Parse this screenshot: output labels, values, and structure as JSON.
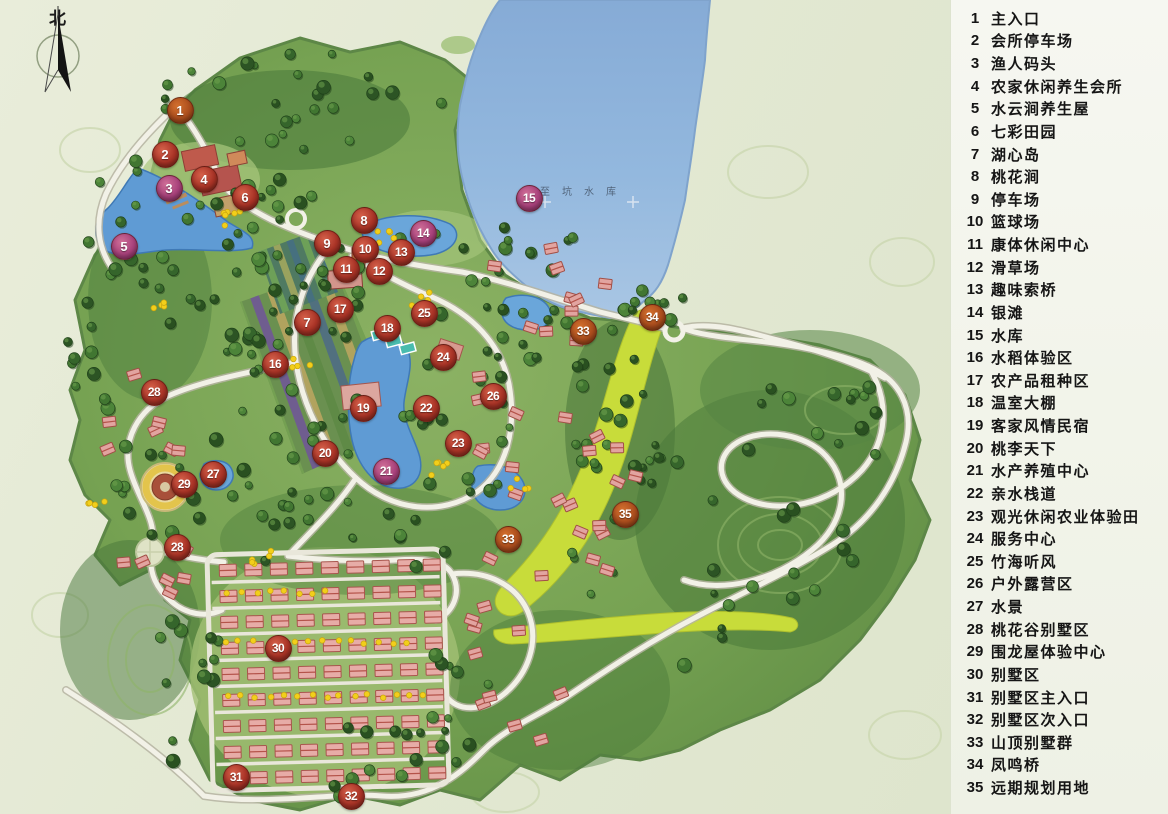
{
  "compass": {
    "north_label": "北"
  },
  "map": {
    "reservoir_label": "至坑水库",
    "markers": [
      {
        "num": "1",
        "x": 180,
        "y": 110,
        "variant": "rust",
        "label": "主入口"
      },
      {
        "num": "2",
        "x": 165,
        "y": 154,
        "variant": "red",
        "label": "会所停车场"
      },
      {
        "num": "3",
        "x": 169,
        "y": 188,
        "variant": "magenta",
        "label": "渔人码头"
      },
      {
        "num": "4",
        "x": 204,
        "y": 179,
        "variant": "red",
        "label": "农家休闲养生会所"
      },
      {
        "num": "5",
        "x": 124,
        "y": 246,
        "variant": "magenta",
        "label": "水云涧养生屋"
      },
      {
        "num": "6",
        "x": 245,
        "y": 197,
        "variant": "red",
        "label": "七彩田园"
      },
      {
        "num": "7",
        "x": 307,
        "y": 322,
        "variant": "red",
        "label": "湖心岛"
      },
      {
        "num": "8",
        "x": 364,
        "y": 220,
        "variant": "red",
        "label": "桃花涧"
      },
      {
        "num": "9",
        "x": 327,
        "y": 243,
        "variant": "red",
        "label": "停车场"
      },
      {
        "num": "10",
        "x": 365,
        "y": 249,
        "variant": "red",
        "label": "篮球场"
      },
      {
        "num": "11",
        "x": 346,
        "y": 269,
        "variant": "red",
        "label": "康体休闲中心"
      },
      {
        "num": "12",
        "x": 379,
        "y": 271,
        "variant": "red",
        "label": "滑草场"
      },
      {
        "num": "13",
        "x": 401,
        "y": 252,
        "variant": "red",
        "label": "趣味索桥"
      },
      {
        "num": "14",
        "x": 423,
        "y": 233,
        "variant": "magenta",
        "label": "银滩"
      },
      {
        "num": "15",
        "x": 529,
        "y": 198,
        "variant": "magenta",
        "label": "水库"
      },
      {
        "num": "16",
        "x": 275,
        "y": 364,
        "variant": "red",
        "label": "水稻体验区"
      },
      {
        "num": "17",
        "x": 340,
        "y": 309,
        "variant": "red",
        "label": "农产品租种区"
      },
      {
        "num": "18",
        "x": 387,
        "y": 328,
        "variant": "red",
        "label": "温室大棚"
      },
      {
        "num": "19",
        "x": 363,
        "y": 408,
        "variant": "red",
        "label": "客家风情民宿"
      },
      {
        "num": "20",
        "x": 325,
        "y": 453,
        "variant": "red",
        "label": "桃李天下"
      },
      {
        "num": "21",
        "x": 386,
        "y": 471,
        "variant": "magenta",
        "label": "水产养殖中心"
      },
      {
        "num": "22",
        "x": 426,
        "y": 408,
        "variant": "red",
        "label": "亲水栈道"
      },
      {
        "num": "23",
        "x": 458,
        "y": 443,
        "variant": "red",
        "label": "观光休闲农业体验田"
      },
      {
        "num": "24",
        "x": 443,
        "y": 357,
        "variant": "red",
        "label": "服务中心"
      },
      {
        "num": "25",
        "x": 424,
        "y": 313,
        "variant": "red",
        "label": "竹海听风"
      },
      {
        "num": "26",
        "x": 493,
        "y": 396,
        "variant": "red",
        "label": "户外露营区"
      },
      {
        "num": "27",
        "x": 213,
        "y": 474,
        "variant": "red",
        "label": "水景"
      },
      {
        "num": "28",
        "x": 154,
        "y": 392,
        "variant": "red",
        "label": "桃花谷别墅区"
      },
      {
        "num": "28",
        "x": 177,
        "y": 547,
        "variant": "red",
        "label": "桃花谷别墅区"
      },
      {
        "num": "29",
        "x": 184,
        "y": 484,
        "variant": "red",
        "label": "围龙屋体验中心"
      },
      {
        "num": "30",
        "x": 278,
        "y": 648,
        "variant": "red",
        "label": "别墅区"
      },
      {
        "num": "31",
        "x": 236,
        "y": 777,
        "variant": "red",
        "label": "别墅区主入口"
      },
      {
        "num": "32",
        "x": 351,
        "y": 796,
        "variant": "red",
        "label": "别墅区次入口"
      },
      {
        "num": "33",
        "x": 583,
        "y": 331,
        "variant": "rust",
        "label": "山顶别墅群"
      },
      {
        "num": "33",
        "x": 508,
        "y": 539,
        "variant": "rust",
        "label": "山顶别墅群"
      },
      {
        "num": "34",
        "x": 652,
        "y": 317,
        "variant": "rust",
        "label": "凤鸣桥"
      },
      {
        "num": "35",
        "x": 625,
        "y": 514,
        "variant": "rust",
        "label": "远期规划用地"
      }
    ]
  },
  "legend": {
    "items": [
      {
        "num": "1",
        "label": "主入口"
      },
      {
        "num": "2",
        "label": "会所停车场"
      },
      {
        "num": "3",
        "label": "渔人码头"
      },
      {
        "num": "4",
        "label": "农家休闲养生会所"
      },
      {
        "num": "5",
        "label": "水云涧养生屋"
      },
      {
        "num": "6",
        "label": "七彩田园"
      },
      {
        "num": "7",
        "label": "湖心岛"
      },
      {
        "num": "8",
        "label": "桃花涧"
      },
      {
        "num": "9",
        "label": "停车场"
      },
      {
        "num": "10",
        "label": "篮球场"
      },
      {
        "num": "11",
        "label": "康体休闲中心"
      },
      {
        "num": "12",
        "label": "滑草场"
      },
      {
        "num": "13",
        "label": "趣味索桥"
      },
      {
        "num": "14",
        "label": "银滩"
      },
      {
        "num": "15",
        "label": "水库"
      },
      {
        "num": "16",
        "label": "水稻体验区"
      },
      {
        "num": "17",
        "label": "农产品租种区"
      },
      {
        "num": "18",
        "label": "温室大棚"
      },
      {
        "num": "19",
        "label": "客家风情民宿"
      },
      {
        "num": "20",
        "label": "桃李天下"
      },
      {
        "num": "21",
        "label": "水产养殖中心"
      },
      {
        "num": "22",
        "label": "亲水栈道"
      },
      {
        "num": "23",
        "label": "观光休闲农业体验田"
      },
      {
        "num": "24",
        "label": "服务中心"
      },
      {
        "num": "25",
        "label": "竹海听风"
      },
      {
        "num": "26",
        "label": "户外露营区"
      },
      {
        "num": "27",
        "label": "水景"
      },
      {
        "num": "28",
        "label": "桃花谷别墅区"
      },
      {
        "num": "29",
        "label": "围龙屋体验中心"
      },
      {
        "num": "30",
        "label": "别墅区"
      },
      {
        "num": "31",
        "label": "别墅区主入口"
      },
      {
        "num": "32",
        "label": "别墅区次入口"
      },
      {
        "num": "33",
        "label": "山顶别墅群"
      },
      {
        "num": "34",
        "label": "凤鸣桥"
      },
      {
        "num": "35",
        "label": "远期规划用地"
      }
    ]
  },
  "colors": {
    "marker_variants": {
      "red": {
        "light": "#d4604a",
        "base": "#a93326",
        "dark": "#76241a"
      },
      "magenta": {
        "light": "#cf6e97",
        "base": "#a8417b",
        "dark": "#772c56"
      },
      "rust": {
        "light": "#d3702e",
        "base": "#ab4d1d",
        "dark": "#783512"
      }
    },
    "reservoir": "#8fb3da",
    "lake": "#5f9bd4",
    "land": "#7fa95c",
    "forest": "#3f6b33",
    "road": "#f2f1e7",
    "future_land": "#c8dc3a",
    "villa": "#e7aca7",
    "legend_text": "#151515"
  }
}
